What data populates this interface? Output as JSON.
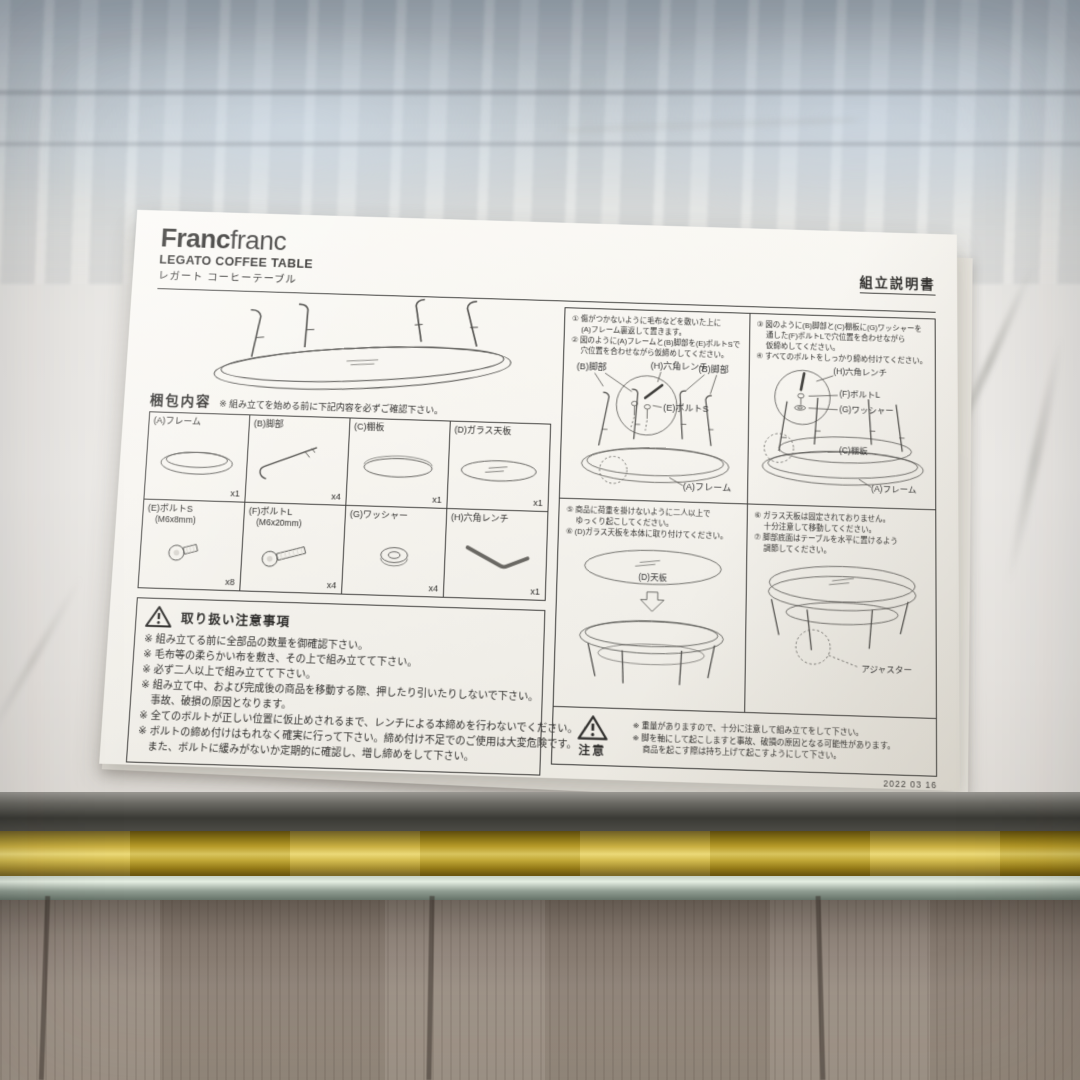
{
  "paper": {
    "logo": {
      "bold": "Franc",
      "light": "franc"
    },
    "product_name_en": "LEGATO COFFEE TABLE",
    "product_name_ja": "レガート コーヒーテーブル",
    "doc_title": "組立説明書",
    "packing": {
      "heading": "梱包内容",
      "note": "※ 組み立てを始める前に下記内容を必ずご確認下さい。",
      "parts": [
        {
          "label": "(A)フレーム",
          "sub": "",
          "qty": "x1",
          "icon": "frame-icon"
        },
        {
          "label": "(B)脚部",
          "sub": "",
          "qty": "x4",
          "icon": "leg-icon"
        },
        {
          "label": "(C)棚板",
          "sub": "",
          "qty": "x1",
          "icon": "shelf-icon"
        },
        {
          "label": "(D)ガラス天板",
          "sub": "",
          "qty": "x1",
          "icon": "glass-top-icon"
        },
        {
          "label": "(E)ボルトS",
          "sub": "(M6x8mm)",
          "qty": "x8",
          "icon": "bolt-short-icon"
        },
        {
          "label": "(F)ボルトL",
          "sub": "(M6x20mm)",
          "qty": "x4",
          "icon": "bolt-long-icon"
        },
        {
          "label": "(G)ワッシャー",
          "sub": "",
          "qty": "x4",
          "icon": "washer-icon"
        },
        {
          "label": "(H)六角レンチ",
          "sub": "",
          "qty": "x1",
          "icon": "hex-wrench-icon"
        }
      ]
    },
    "handling": {
      "heading": "取り扱い注意事項",
      "icon": "warning-triangle-icon",
      "lines": [
        "※ 組み立てる前に全部品の数量を御確認下さい。",
        "※ 毛布等の柔らかい布を敷き、その上で組み立てて下さい。",
        "※ 必ず二人以上で組み立てて下さい。",
        "※ 組み立て中、および完成後の商品を移動する際、押したり引いたりしないで下さい。",
        "　事故、破損の原因となります。",
        "※ 全てのボルトが正しい位置に仮止めされるまで、レンチによる本締めを行わないでください。",
        "※ ボルトの締め付けはもれなく確実に行って下さい。締め付け不足でのご使用は大変危険です。",
        "　また、ボルトに緩みがないか定期的に確認し、増し締めをして下さい。"
      ]
    },
    "steps": {
      "panel1": {
        "lines": [
          "① 傷がつかないように毛布などを敷いた上に",
          "　 (A)フレーム裏返して置きます。",
          "② 図のように(A)フレームと(B)脚部を(E)ボルトSで",
          "　 穴位置を合わせながら仮締めしてください。"
        ],
        "labels": {
          "leg_left": "(B)脚部",
          "wrench": "(H)六角レンチ",
          "bolt": "(E)ボルトS",
          "leg_right": "(B)脚部",
          "frame": "(A)フレーム"
        }
      },
      "panel2": {
        "lines": [
          "③ 図のように(B)脚部と(C)棚板に(G)ワッシャーを",
          "　 通した(F)ボルトLで穴位置を合わせながら",
          "　 仮締めしてください。",
          "④ すべてのボルトをしっかり締め付けてください。"
        ],
        "labels": {
          "wrench": "(H)六角レンチ",
          "bolt": "(F)ボルトL",
          "washer": "(G)ワッシャー",
          "shelf": "(C)棚板",
          "frame": "(A)フレーム"
        }
      },
      "panel3": {
        "lines": [
          "⑤ 商品に荷重を掛けないように二人以上で",
          "　 ゆっくり起こしてください。",
          "⑥ (D)ガラス天板を本体に取り付けてください。"
        ],
        "labels": {
          "top": "(D)天板"
        }
      },
      "panel4": {
        "lines": [
          "⑥ ガラス天板は固定されておりません。",
          "　 十分注意して移動してください。",
          "⑦ 脚部底面はテーブルを水平に置けるよう",
          "　 アジャスターが付いています。必要に応じて",
          "　 調節してください。"
        ],
        "labels": {
          "adjuster": "アジャスター"
        }
      }
    },
    "caution": {
      "heading": "注意",
      "icon": "warning-triangle-icon",
      "lines": [
        "※ 重量がありますので、十分に注意して組み立てをして下さい。",
        "※ 脚を軸にして起こしますと事故、破損の原因となる可能性があります。",
        "　 商品を起こす際は持ち上げて起こすようにして下さい。"
      ]
    },
    "date": "2022 03 16"
  }
}
